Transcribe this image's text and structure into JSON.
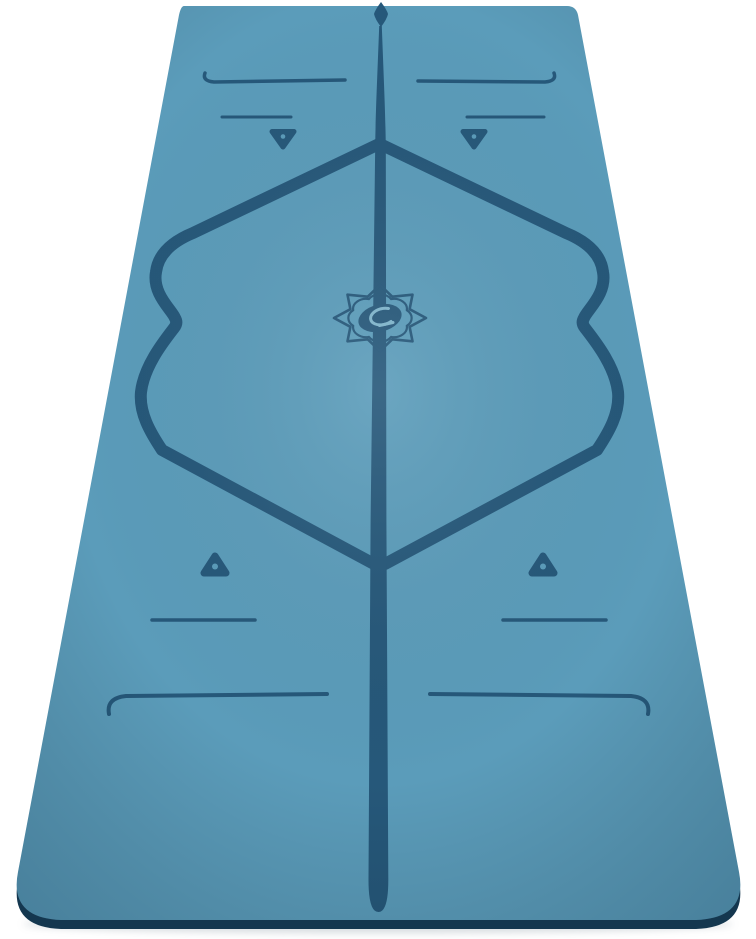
{
  "page": {
    "background_color": "#ffffff",
    "content_type": "product-photo",
    "subject": "Blue yoga mat with etched alignment guide markings, standing upright in perspective on a white background"
  },
  "mat": {
    "colors": {
      "surface": "#5B9CBA",
      "marking": "#26587A",
      "edge": "#14374F",
      "logo_highlight": "#7FB5CC"
    },
    "logo": "lotus-oval-monogram",
    "marking_names": [
      "top-arrow",
      "center-guide-line",
      "upper-end-line-left",
      "upper-end-line-right",
      "upper-hand-line-left",
      "upper-hand-line-right",
      "upper-triangle-marker-left",
      "upper-triangle-marker-right",
      "alignment-frame-left",
      "alignment-frame-right",
      "lotus-logo-medallion",
      "lower-triangle-marker-left",
      "lower-triangle-marker-right",
      "lower-hand-line-left",
      "lower-hand-line-right",
      "lower-end-line-left",
      "lower-end-line-right"
    ]
  }
}
